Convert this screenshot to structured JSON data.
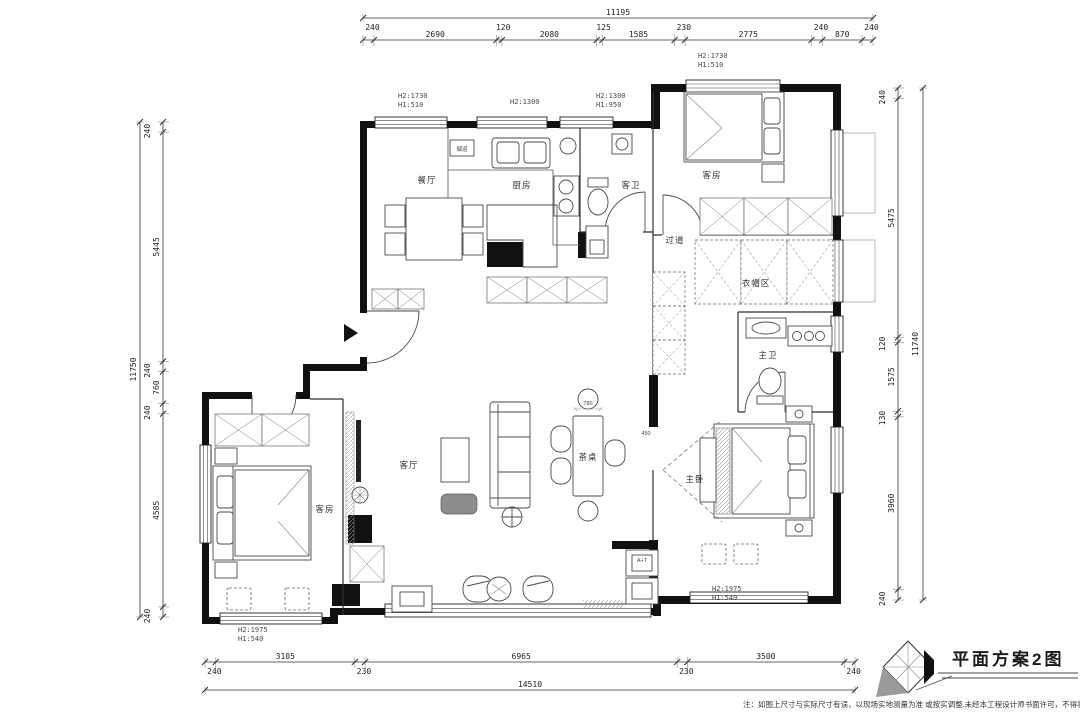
{
  "drawing": {
    "title": "平面方案2图",
    "note": "注：如图上尺寸与实际尺寸有误，以现场实地测量为准 或按实调整.未经本工程设计师书面许可，不得将任何部分翻"
  },
  "rooms": {
    "dining": "餐厅",
    "kitchen": "厨房",
    "guest_bath": "客卫",
    "guest_room_top": "客房",
    "hallway": "过道",
    "cloak_area": "衣帽区",
    "master_bath": "主卫",
    "master_bedroom": "主卧",
    "living": "客厅",
    "guest_room_bottom": "客房",
    "tea_table": "茶桌"
  },
  "annotations": {
    "tea_table_width": "780",
    "cabinet_depth": "450",
    "entry_cabinet": "A+T",
    "flue": "烟道"
  },
  "window_tags": [
    {
      "h2": "H2:1730",
      "h1": "H1:510"
    },
    {
      "h2": "H2:1300",
      "h1": ""
    },
    {
      "h2": "H2:1300",
      "h1": "H1:950"
    },
    {
      "h2": "H2:1730",
      "h1": "H1:510"
    },
    {
      "h2": "H2:1975",
      "h1": "H1:540"
    },
    {
      "h2": "H2:1975",
      "h1": "H1:540"
    }
  ],
  "dimensions": {
    "top": {
      "total": "11195",
      "segments": [
        "240",
        "2690",
        "120",
        "2080",
        "125",
        "1585",
        "230",
        "2775",
        "240",
        "870",
        "240"
      ]
    },
    "bottom": {
      "total": "14510",
      "segments": [
        "240",
        "3105",
        "230",
        "6965",
        "230",
        "3500",
        "240"
      ]
    },
    "left": {
      "total": "11750",
      "segments": [
        "240",
        "5445",
        "240",
        "760",
        "240",
        "4585",
        "240"
      ]
    },
    "right": {
      "total": "11740",
      "segments": [
        "240",
        "5475",
        "120",
        "1575",
        "130",
        "3960",
        "240"
      ]
    }
  }
}
